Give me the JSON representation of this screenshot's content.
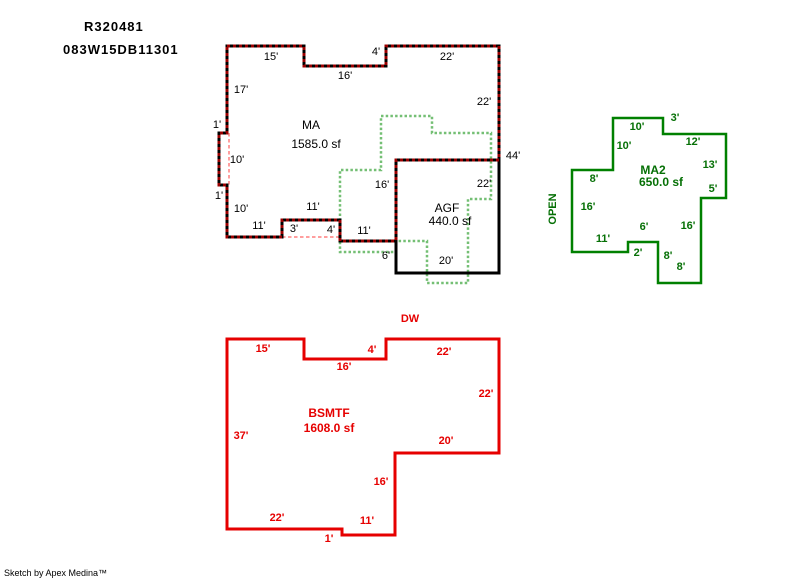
{
  "header": {
    "parcel_id": "R320481",
    "account_number": "083W15DB11301"
  },
  "footer": {
    "credit": "Sketch by Apex Medina™"
  },
  "colors": {
    "main_wall": "#000000",
    "main_wall_dash": "#990000",
    "agf_wall": "#000000",
    "hidden_wall": "#ff9e9e",
    "upper_floor_dotted": "#74bf74",
    "ma2_wall": "#008000",
    "ma2_text": "#067006",
    "bsmtf_wall": "#e60000",
    "bsmtf_text": "#e60000",
    "label_text": "#000000",
    "background": "#ffffff"
  },
  "sketch": {
    "shapes": [
      {
        "name": "upper-floor-dotted-outline",
        "color": "#74bf74",
        "width": 2.5,
        "dash": "2.5,2.2",
        "closed": true,
        "points": [
          [
            381,
            116
          ],
          [
            432,
            116
          ],
          [
            432,
            133
          ],
          [
            491,
            133
          ],
          [
            491,
            199
          ],
          [
            468,
            199
          ],
          [
            468,
            283
          ],
          [
            427,
            283
          ],
          [
            427,
            241
          ],
          [
            396,
            241
          ],
          [
            396,
            252
          ],
          [
            340,
            252
          ],
          [
            340,
            170
          ],
          [
            381,
            170
          ]
        ]
      },
      {
        "name": "hidden-wall-left",
        "color": "#ff9e9e",
        "width": 2,
        "dash": "3.5,2.5",
        "closed": false,
        "points": [
          [
            229,
            133
          ],
          [
            229,
            185
          ]
        ]
      },
      {
        "name": "hidden-wall-bottom",
        "color": "#ff9e9e",
        "width": 2,
        "dash": "3.5,2.5",
        "closed": false,
        "points": [
          [
            282,
            237
          ],
          [
            340,
            237
          ]
        ]
      },
      {
        "name": "agf-outline",
        "color": "#000000",
        "width": 3,
        "dash": "",
        "closed": true,
        "points": [
          [
            396,
            160
          ],
          [
            499,
            160
          ],
          [
            499,
            273
          ],
          [
            396,
            273
          ]
        ]
      },
      {
        "name": "ma-outline",
        "color": "#000000",
        "width": 3,
        "dash": "",
        "closed": true,
        "points": [
          [
            227,
            46
          ],
          [
            304,
            46
          ],
          [
            304,
            66
          ],
          [
            386,
            66
          ],
          [
            386,
            46
          ],
          [
            499,
            46
          ],
          [
            499,
            160
          ],
          [
            396,
            160
          ],
          [
            396,
            241
          ],
          [
            340,
            241
          ],
          [
            340,
            220
          ],
          [
            282,
            220
          ],
          [
            282,
            237
          ],
          [
            227,
            237
          ],
          [
            227,
            185
          ],
          [
            219,
            185
          ],
          [
            219,
            133
          ],
          [
            227,
            133
          ]
        ]
      },
      {
        "name": "ma-outline-dash-overlay",
        "color": "#990000",
        "width": 3,
        "dash": "3,3",
        "closed": true,
        "points": [
          [
            227,
            46
          ],
          [
            304,
            46
          ],
          [
            304,
            66
          ],
          [
            386,
            66
          ],
          [
            386,
            46
          ],
          [
            499,
            46
          ],
          [
            499,
            160
          ],
          [
            396,
            160
          ],
          [
            396,
            241
          ],
          [
            340,
            241
          ],
          [
            340,
            220
          ],
          [
            282,
            220
          ],
          [
            282,
            237
          ],
          [
            227,
            237
          ],
          [
            227,
            185
          ],
          [
            219,
            185
          ],
          [
            219,
            133
          ],
          [
            227,
            133
          ]
        ]
      },
      {
        "name": "ma2-outline",
        "color": "#008000",
        "width": 2.5,
        "dash": "",
        "closed": true,
        "points": [
          [
            613,
            118
          ],
          [
            663,
            118
          ],
          [
            663,
            134
          ],
          [
            726,
            134
          ],
          [
            726,
            198
          ],
          [
            701,
            198
          ],
          [
            701,
            283
          ],
          [
            658,
            283
          ],
          [
            658,
            242
          ],
          [
            628,
            242
          ],
          [
            628,
            252
          ],
          [
            572,
            252
          ],
          [
            572,
            170
          ],
          [
            613,
            170
          ]
        ]
      },
      {
        "name": "bsmtf-outline",
        "color": "#e60000",
        "width": 3,
        "dash": "",
        "closed": true,
        "points": [
          [
            227,
            339
          ],
          [
            304,
            339
          ],
          [
            304,
            359
          ],
          [
            386,
            359
          ],
          [
            386,
            339
          ],
          [
            499,
            339
          ],
          [
            499,
            453
          ],
          [
            395,
            453
          ],
          [
            395,
            535
          ],
          [
            342,
            535
          ],
          [
            342,
            529
          ],
          [
            227,
            529
          ]
        ]
      }
    ],
    "areas": [
      {
        "id": "ma",
        "text_class": "t-ma",
        "name_label": {
          "t": "MA",
          "x": 311,
          "y": 125
        },
        "sqft_label": {
          "t": "1585.0 sf",
          "x": 316,
          "y": 144
        },
        "dims": [
          {
            "t": "15'",
            "x": 271,
            "y": 57
          },
          {
            "t": "4'",
            "x": 376,
            "y": 52
          },
          {
            "t": "22'",
            "x": 447,
            "y": 57
          },
          {
            "t": "16'",
            "x": 345,
            "y": 76
          },
          {
            "t": "17'",
            "x": 241,
            "y": 90
          },
          {
            "t": "22'",
            "x": 484,
            "y": 102
          },
          {
            "t": "1'",
            "x": 217,
            "y": 125
          },
          {
            "t": "10'",
            "x": 237,
            "y": 160
          },
          {
            "t": "1'",
            "x": 219,
            "y": 196
          },
          {
            "t": "10'",
            "x": 241,
            "y": 209
          },
          {
            "t": "11'",
            "x": 259,
            "y": 226
          },
          {
            "t": "11'",
            "x": 313,
            "y": 207
          },
          {
            "t": "3'",
            "x": 294,
            "y": 229
          },
          {
            "t": "4'",
            "x": 331,
            "y": 230
          },
          {
            "t": "11'",
            "x": 364,
            "y": 231
          },
          {
            "t": "6'",
            "x": 386,
            "y": 256
          },
          {
            "t": "16'",
            "x": 382,
            "y": 185
          },
          {
            "t": "44'",
            "x": 513,
            "y": 156
          }
        ],
        "extras": []
      },
      {
        "id": "agf",
        "text_class": "t-ma",
        "name_label": {
          "t": "AGF",
          "x": 447,
          "y": 208
        },
        "sqft_label": {
          "t": "440.0 sf",
          "x": 450,
          "y": 221
        },
        "dims": [
          {
            "t": "22'",
            "x": 484,
            "y": 184
          },
          {
            "t": "20'",
            "x": 446,
            "y": 261
          }
        ],
        "extras": []
      },
      {
        "id": "ma2",
        "text_class": "t-ma2",
        "name_label": {
          "t": "MA2",
          "x": 653,
          "y": 170
        },
        "sqft_label": {
          "t": "650.0 sf",
          "x": 661,
          "y": 182
        },
        "dims": [
          {
            "t": "10'",
            "x": 637,
            "y": 127
          },
          {
            "t": "3'",
            "x": 675,
            "y": 118
          },
          {
            "t": "10'",
            "x": 624,
            "y": 146
          },
          {
            "t": "12'",
            "x": 693,
            "y": 142
          },
          {
            "t": "13'",
            "x": 710,
            "y": 165
          },
          {
            "t": "5'",
            "x": 713,
            "y": 189
          },
          {
            "t": "8'",
            "x": 594,
            "y": 179
          },
          {
            "t": "16'",
            "x": 588,
            "y": 207
          },
          {
            "t": "6'",
            "x": 644,
            "y": 227
          },
          {
            "t": "16'",
            "x": 688,
            "y": 226
          },
          {
            "t": "11'",
            "x": 603,
            "y": 239
          },
          {
            "t": "2'",
            "x": 638,
            "y": 253
          },
          {
            "t": "8'",
            "x": 668,
            "y": 256
          },
          {
            "t": "8'",
            "x": 681,
            "y": 267
          }
        ],
        "extras": [
          {
            "t": "OPEN",
            "x": 553,
            "y": 209,
            "rotate": -90,
            "name": "open-label"
          }
        ]
      },
      {
        "id": "bsmtf",
        "text_class": "t-bsmtf",
        "name_label": {
          "t": "BSMTF",
          "x": 329,
          "y": 413
        },
        "sqft_label": {
          "t": "1608.0 sf",
          "x": 329,
          "y": 428
        },
        "dims": [
          {
            "t": "15'",
            "x": 263,
            "y": 349
          },
          {
            "t": "4'",
            "x": 372,
            "y": 350
          },
          {
            "t": "22'",
            "x": 444,
            "y": 352
          },
          {
            "t": "16'",
            "x": 344,
            "y": 367
          },
          {
            "t": "22'",
            "x": 486,
            "y": 394
          },
          {
            "t": "20'",
            "x": 446,
            "y": 441
          },
          {
            "t": "16'",
            "x": 381,
            "y": 482
          },
          {
            "t": "11'",
            "x": 367,
            "y": 521
          },
          {
            "t": "1'",
            "x": 329,
            "y": 539
          },
          {
            "t": "22'",
            "x": 277,
            "y": 518
          },
          {
            "t": "37'",
            "x": 241,
            "y": 436
          }
        ],
        "extras": [
          {
            "t": "DW",
            "x": 410,
            "y": 319,
            "name": "dw-label"
          }
        ]
      }
    ]
  }
}
